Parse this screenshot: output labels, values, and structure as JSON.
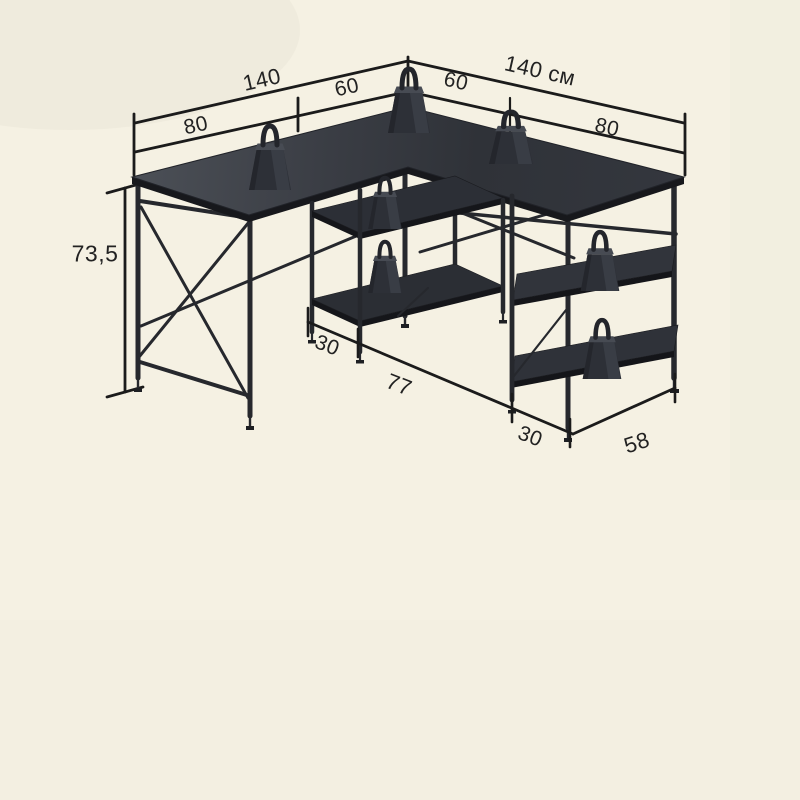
{
  "diagram": {
    "kind": "furniture-dimension-drawing",
    "subject": "L-shaped desk with storage shelves and load test weights",
    "unit": "cm",
    "colors": {
      "background": "#f5f1e3",
      "dimension_line": "#1b1b1b",
      "desk_top": "#33363d",
      "desk_edge": "#17181c",
      "frame": "#26282d",
      "text": "#222222"
    },
    "labels": {
      "left_length": "140",
      "left_depth": "60",
      "right_depth": "60",
      "right_length": "140 см",
      "left_overhang": "80",
      "right_overhang": "80",
      "height": "73,5",
      "middle_shelf_depth": "30",
      "knee_space": "77",
      "right_shelf_depth": "30",
      "right_shelf_width": "58"
    }
  }
}
